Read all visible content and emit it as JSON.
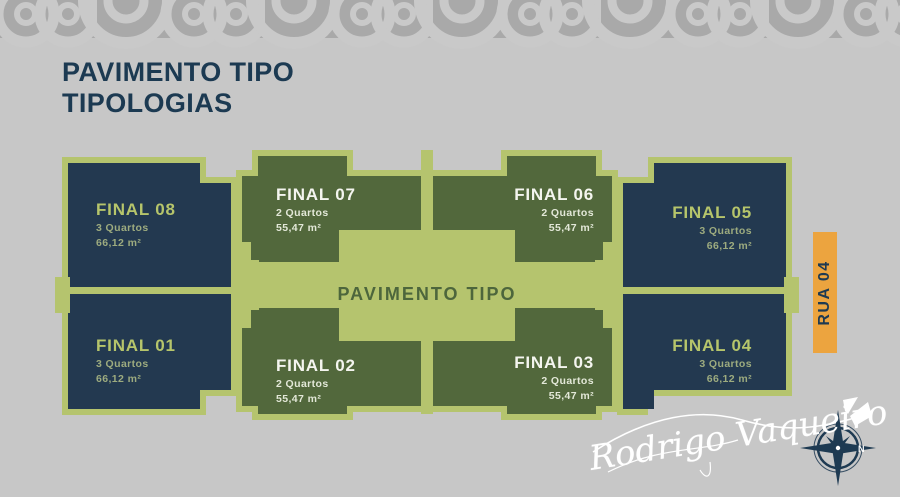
{
  "header": {
    "title_line1": "PAVIMENTO TIPO",
    "title_line2": "TIPOLOGIAS"
  },
  "plan": {
    "center_label": "PAVIMENTO TIPO",
    "units": {
      "f08": {
        "name": "FINAL 08",
        "rooms": "3 Quartos",
        "area": "66,12 m²"
      },
      "f07": {
        "name": "FINAL 07",
        "rooms": "2 Quartos",
        "area": "55,47 m²"
      },
      "f06": {
        "name": "FINAL 06",
        "rooms": "2 Quartos",
        "area": "55,47 m²"
      },
      "f05": {
        "name": "FINAL 05",
        "rooms": "3 Quartos",
        "area": "66,12 m²"
      },
      "f01": {
        "name": "FINAL 01",
        "rooms": "3 Quartos",
        "area": "66,12 m²"
      },
      "f02": {
        "name": "FINAL 02",
        "rooms": "2 Quartos",
        "area": "55,47 m²"
      },
      "f03": {
        "name": "FINAL 03",
        "rooms": "2 Quartos",
        "area": "55,47 m²"
      },
      "f04": {
        "name": "FINAL 04",
        "rooms": "3 Quartos",
        "area": "66,12 m²"
      }
    }
  },
  "street_label": "RUA 04",
  "signature": {
    "name": "Rodrigo Vaqueiro",
    "compass_label": "N"
  },
  "colors": {
    "navy_unit": "#233950",
    "green_unit": "#52683c",
    "light_green": "#b5c46e",
    "orange": "#eca43f",
    "page_background": "#c7c7c7",
    "pattern_background": "#a9a9a9",
    "pattern_arc": "#c9c9c9",
    "title_text": "#1c3a52"
  }
}
